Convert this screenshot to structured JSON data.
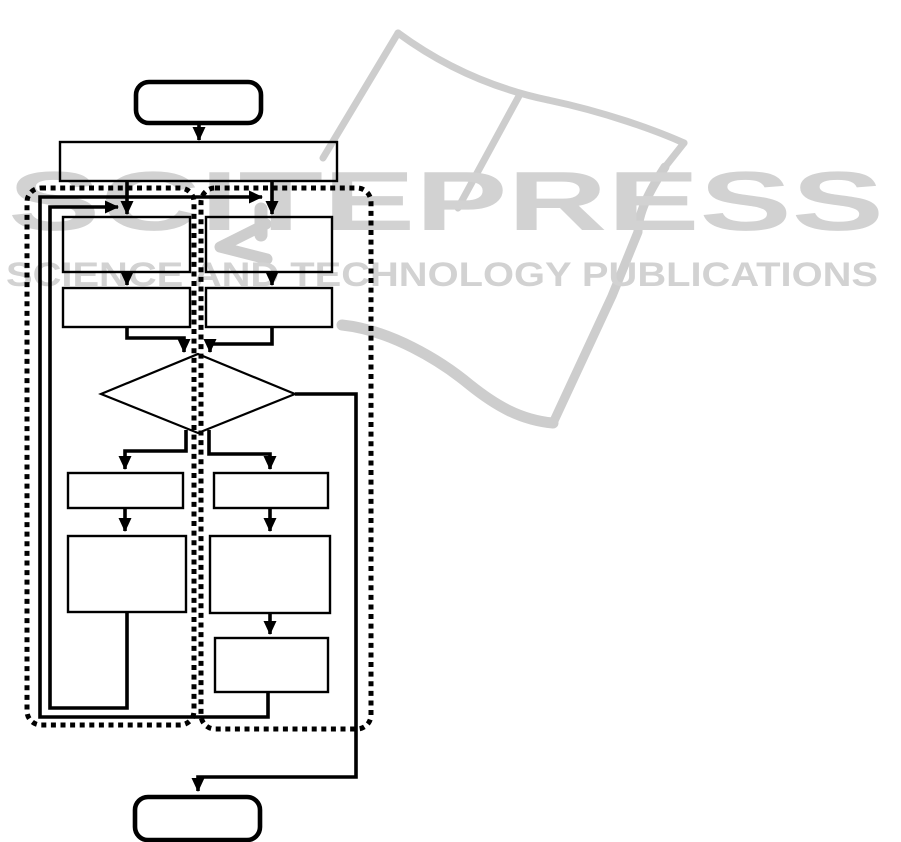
{
  "figure": {
    "kind": "flowchart",
    "background": "#ffffff",
    "line_color": "#000000"
  },
  "watermark": {
    "title": "SCITEPRESS",
    "subtitle": "SCIENCE AND TECHNOLOGY PUBLICATIONS",
    "text_color": "#d2d2d2",
    "stroke_color": "#cdcdcd",
    "book_strokes": [
      {
        "name": "left-page-top-edge",
        "path": "M398,33 C455,75 510,92 548,100",
        "w": 7
      },
      {
        "name": "left-page-left-edge",
        "path": "M398,33 L323,158",
        "w": 7
      },
      {
        "name": "spine-fold",
        "path": "M519,96 L458,208",
        "w": 7
      },
      {
        "name": "right-page-top-edge",
        "path": "M548,100 C605,112 655,130 684,143",
        "w": 7
      },
      {
        "name": "right-page-right-edge",
        "path": "M684,143 L665,167",
        "w": 7
      },
      {
        "name": "right-page-fore-edge",
        "path": "M665,167 C648,193 638,214 638,232 L612,296 L553,423",
        "w": 9
      },
      {
        "name": "page-bottom-edge",
        "path": "M553,423 C520,420 495,405 470,385 C440,360 390,330 342,325",
        "w": 11
      },
      {
        "name": "logo-bar",
        "path": "M261,209 L261,235",
        "w": 13
      },
      {
        "name": "logo-chevron",
        "path": "M266,224 L220,247 L267,259",
        "w": 11
      }
    ]
  },
  "diagram": {
    "lanes": [
      {
        "name": "left-lane",
        "x": 27,
        "y": 188,
        "w": 167,
        "h": 537,
        "rx": 14
      },
      {
        "name": "right-lane",
        "x": 201,
        "y": 188,
        "w": 170,
        "h": 541,
        "rx": 14
      }
    ],
    "nodes": [
      {
        "id": "start-terminator",
        "shape": "terminator",
        "x": 136,
        "y": 82,
        "w": 125,
        "h": 41,
        "rx": 13,
        "sw": 4.6
      },
      {
        "id": "init-process",
        "shape": "process",
        "x": 60,
        "y": 142,
        "w": 277,
        "h": 39,
        "sw": 2.4
      },
      {
        "id": "left-step-1",
        "shape": "process",
        "x": 63,
        "y": 217,
        "w": 127,
        "h": 55,
        "sw": 2.4
      },
      {
        "id": "right-step-1",
        "shape": "process",
        "x": 206,
        "y": 217,
        "w": 126,
        "h": 55,
        "sw": 2.4
      },
      {
        "id": "left-step-2",
        "shape": "process",
        "x": 63,
        "y": 288,
        "w": 127,
        "h": 39,
        "sw": 2.4
      },
      {
        "id": "right-step-2",
        "shape": "process",
        "x": 206,
        "y": 288,
        "w": 126,
        "h": 39,
        "sw": 2.4
      },
      {
        "id": "decision-diamond",
        "shape": "decision",
        "points": "198,354 295,394 198,433 101,394",
        "sw": 2.2
      },
      {
        "id": "left-step-3",
        "shape": "process",
        "x": 68,
        "y": 473,
        "w": 115,
        "h": 35,
        "sw": 2.4
      },
      {
        "id": "right-step-3",
        "shape": "process",
        "x": 214,
        "y": 473,
        "w": 114,
        "h": 35,
        "sw": 2.4
      },
      {
        "id": "left-step-4",
        "shape": "process",
        "x": 68,
        "y": 536,
        "w": 118,
        "h": 76,
        "sw": 2.4
      },
      {
        "id": "right-step-4",
        "shape": "process",
        "x": 210,
        "y": 536,
        "w": 120,
        "h": 77,
        "sw": 2.4
      },
      {
        "id": "right-step-5",
        "shape": "process",
        "x": 215,
        "y": 638,
        "w": 113,
        "h": 54,
        "sw": 2.4
      },
      {
        "id": "end-terminator",
        "shape": "terminator",
        "x": 135,
        "y": 797,
        "w": 125,
        "h": 43,
        "rx": 13,
        "sw": 4.6
      }
    ],
    "edges": [
      {
        "name": "edge-start-to-init",
        "path": "M199,123 L199,140",
        "arrow": true
      },
      {
        "name": "edge-init-to-left1",
        "path": "M127,181 L127,214",
        "arrow": true
      },
      {
        "name": "edge-init-to-right1",
        "path": "M272,181 L272,214",
        "arrow": true
      },
      {
        "name": "edge-left1-to-left2",
        "path": "M127,272 L127,285",
        "arrow": true
      },
      {
        "name": "edge-right1-to-right2",
        "path": "M272,272 L272,285",
        "arrow": true
      },
      {
        "name": "edge-left2-to-decision",
        "path": "M127,327 L127,338 L184,338 L184,352",
        "arrow": true
      },
      {
        "name": "edge-right2-to-decision",
        "path": "M272,327 L272,344 L210,344 L210,352",
        "arrow": true
      },
      {
        "name": "edge-decision-to-left3",
        "path": "M186,430 L186,451 L125,451 L125,469",
        "arrow": true
      },
      {
        "name": "edge-decision-to-right3",
        "path": "M209,430 L209,454 L270,454 L270,469",
        "arrow": true
      },
      {
        "name": "edge-left3-to-left4",
        "path": "M125,508 L125,531",
        "arrow": true
      },
      {
        "name": "edge-right3-to-right4",
        "path": "M270,508 L270,531",
        "arrow": true
      },
      {
        "name": "edge-right4-to-right5",
        "path": "M270,613 L270,634",
        "arrow": true
      },
      {
        "name": "edge-left-loop-back",
        "path": "M127,612 L127,708 L50,708 L50,207 L118,207",
        "arrow": true
      },
      {
        "name": "edge-right-loop-back",
        "path": "M268,692 L268,717 L40,717 L40,197 L262,197",
        "arrow": true
      },
      {
        "name": "edge-decision-exit-to-end",
        "path": "M295,394 L356,394 L356,777 L198,777 L198,791",
        "arrow": true
      }
    ],
    "edge_stroke": 3.6,
    "lane_stroke": 5,
    "lane_dash": "5 4.6"
  }
}
